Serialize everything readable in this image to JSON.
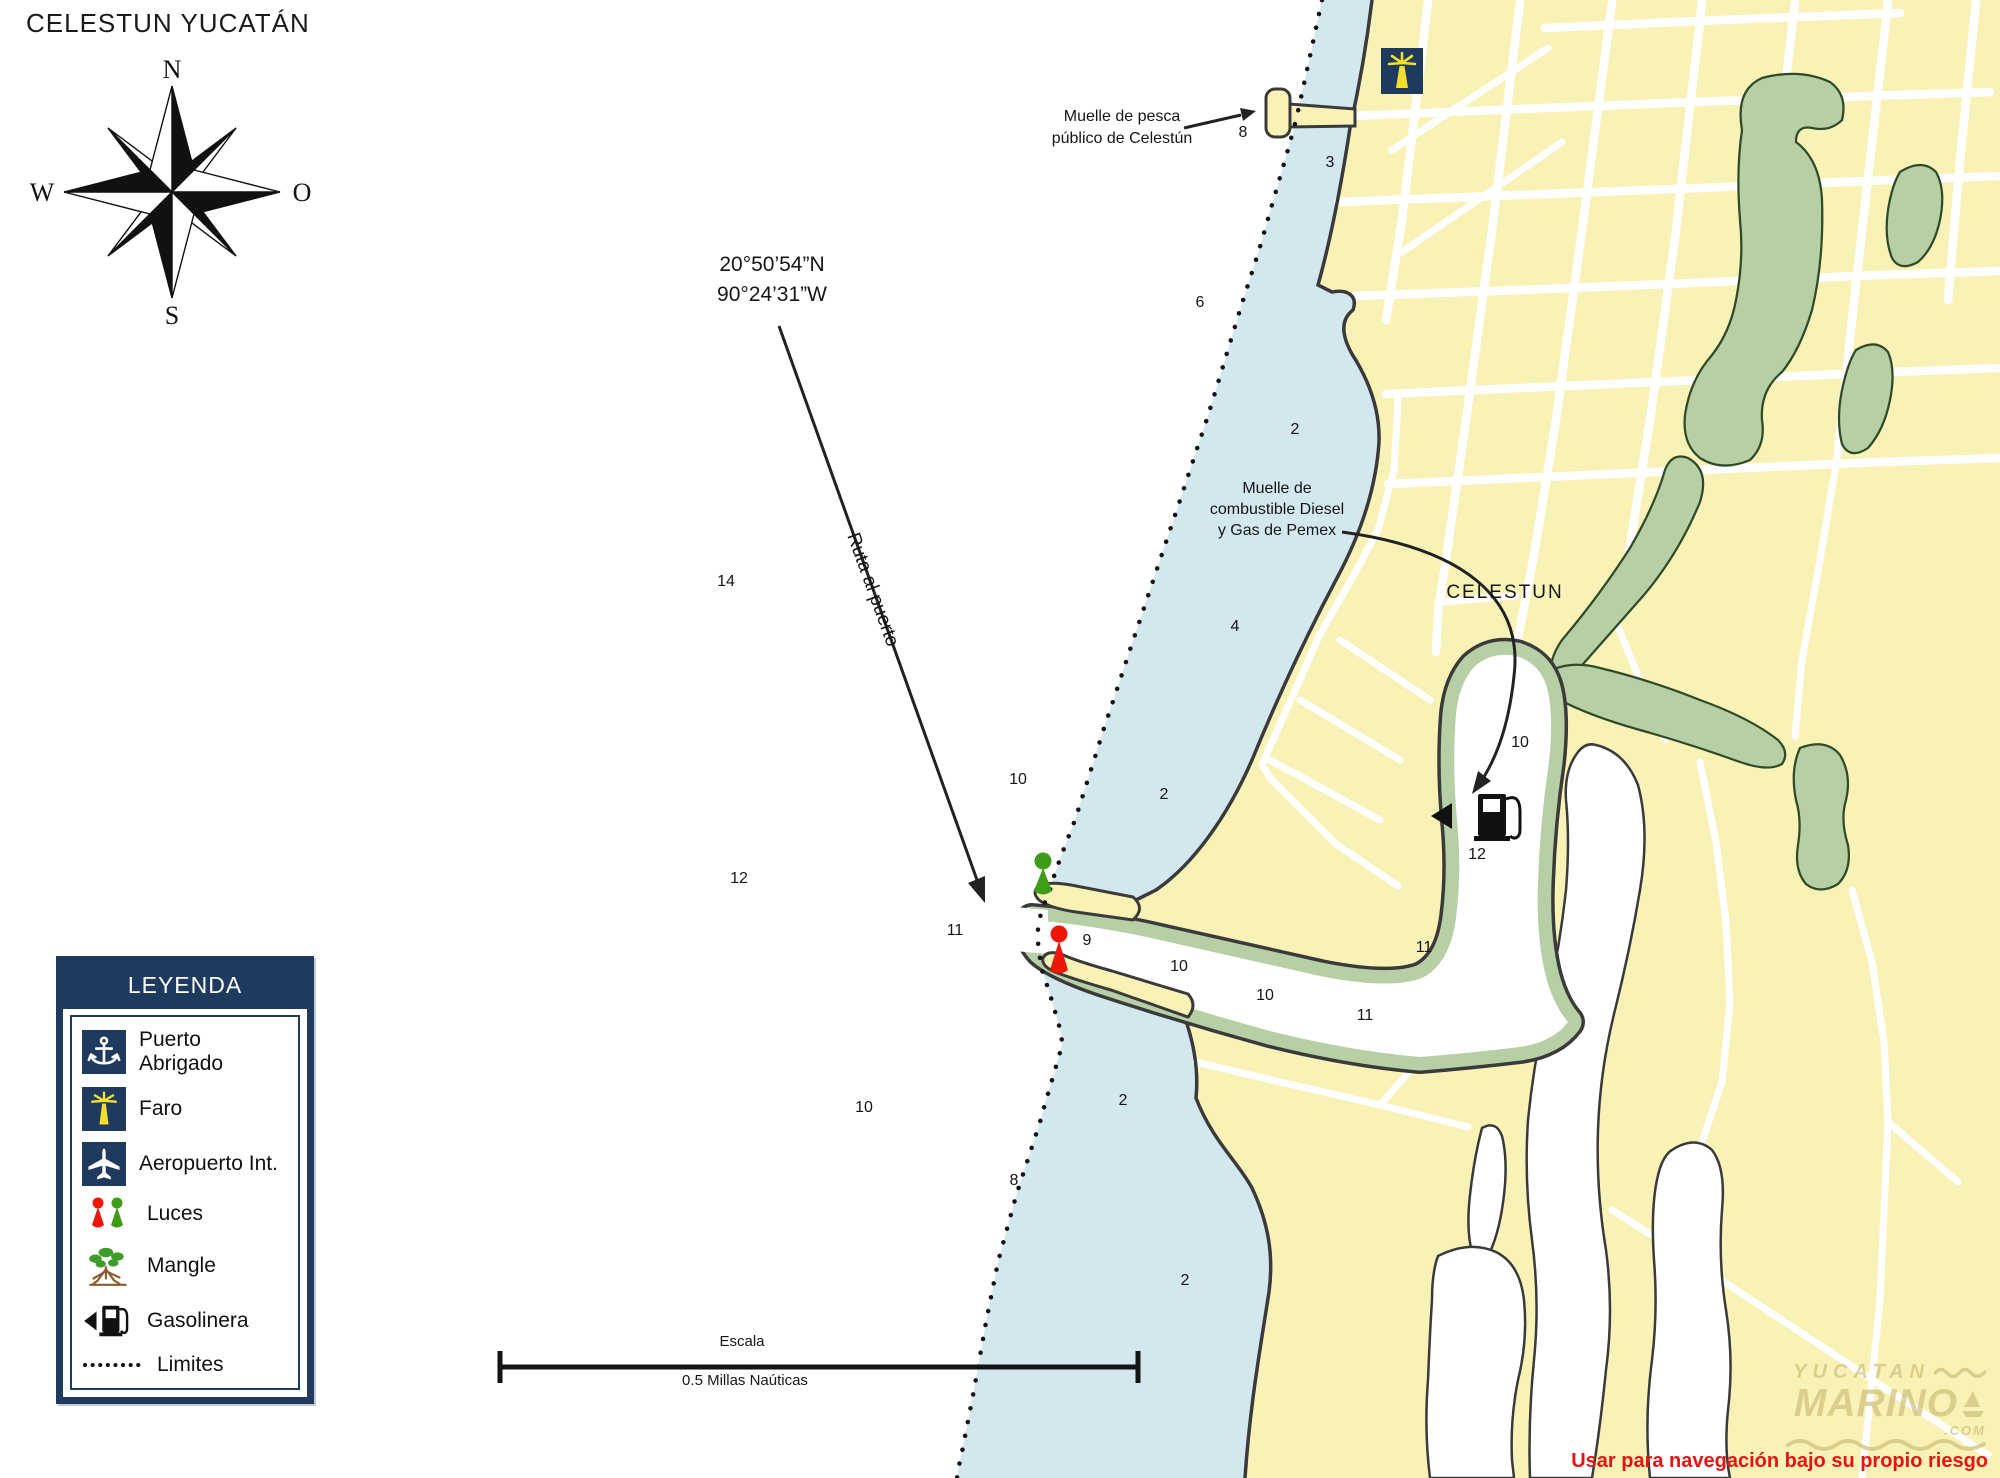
{
  "title": "CELESTUN YUCATÁN",
  "compass": {
    "north": "N",
    "south": "S",
    "west": "W",
    "east": "O"
  },
  "annotations": {
    "coordinates_line1": "20°50’54”N",
    "coordinates_line2": "90°24’31”W",
    "route_label": "Ruta al puerto",
    "fishing_pier_line1": "Muelle de pesca",
    "fishing_pier_line2": "público de Celestún",
    "fuel_pier_line1": "Muelle de",
    "fuel_pier_line2": "combustible Diesel",
    "fuel_pier_line3": "y Gas de Pemex",
    "town_label": "CELESTUN"
  },
  "legend": {
    "header": "LEYENDA",
    "items": [
      {
        "icon": "anchor-icon",
        "label": "Puerto Abrigado"
      },
      {
        "icon": "lighthouse-icon",
        "label": "Faro"
      },
      {
        "icon": "airplane-icon",
        "label": "Aeropuerto Int."
      },
      {
        "icon": "lights-icon",
        "label": "Luces"
      },
      {
        "icon": "mangrove-icon",
        "label": "Mangle"
      },
      {
        "icon": "gas-pump-icon",
        "label": "Gasolinera"
      },
      {
        "icon": "dotted-line-icon",
        "label": "Limites"
      }
    ]
  },
  "scale_bar": {
    "title": "Escala",
    "label": "0.5 Millas Naúticas"
  },
  "soundings": [
    {
      "v": "8",
      "x": 1243,
      "y": 133
    },
    {
      "v": "3",
      "x": 1330,
      "y": 163
    },
    {
      "v": "6",
      "x": 1200,
      "y": 303
    },
    {
      "v": "2",
      "x": 1295,
      "y": 430
    },
    {
      "v": "14",
      "x": 726,
      "y": 582
    },
    {
      "v": "4",
      "x": 1235,
      "y": 627
    },
    {
      "v": "10",
      "x": 1018,
      "y": 780
    },
    {
      "v": "2",
      "x": 1164,
      "y": 795
    },
    {
      "v": "12",
      "x": 739,
      "y": 879
    },
    {
      "v": "11",
      "x": 955,
      "y": 931
    },
    {
      "v": "9",
      "x": 1087,
      "y": 941
    },
    {
      "v": "10",
      "x": 1179,
      "y": 967
    },
    {
      "v": "10",
      "x": 1265,
      "y": 996
    },
    {
      "v": "11",
      "x": 1424,
      "y": 948
    },
    {
      "v": "11",
      "x": 1365,
      "y": 1016
    },
    {
      "v": "10",
      "x": 1520,
      "y": 743
    },
    {
      "v": "12",
      "x": 1477,
      "y": 855
    },
    {
      "v": "10",
      "x": 864,
      "y": 1108
    },
    {
      "v": "2",
      "x": 1123,
      "y": 1101
    },
    {
      "v": "8",
      "x": 1014,
      "y": 1181
    },
    {
      "v": "2",
      "x": 1185,
      "y": 1281
    }
  ],
  "watermark": {
    "line1": "YUCATAN",
    "line2": "MARINO",
    "tld": ".COM"
  },
  "disclaimer": "Usar para navegación bajo su propio riesgo",
  "colors": {
    "sea": "#ffffff",
    "nearshore_water": "#d3e7ef",
    "land": "#f9f2b7",
    "mangrove": "#b7cfa5",
    "coastline": "#3a3a3a",
    "legend_navy": "#1e3a5e",
    "green_light": "#3f9c16",
    "red_light": "#ee1607",
    "warning_red": "#e51414"
  }
}
